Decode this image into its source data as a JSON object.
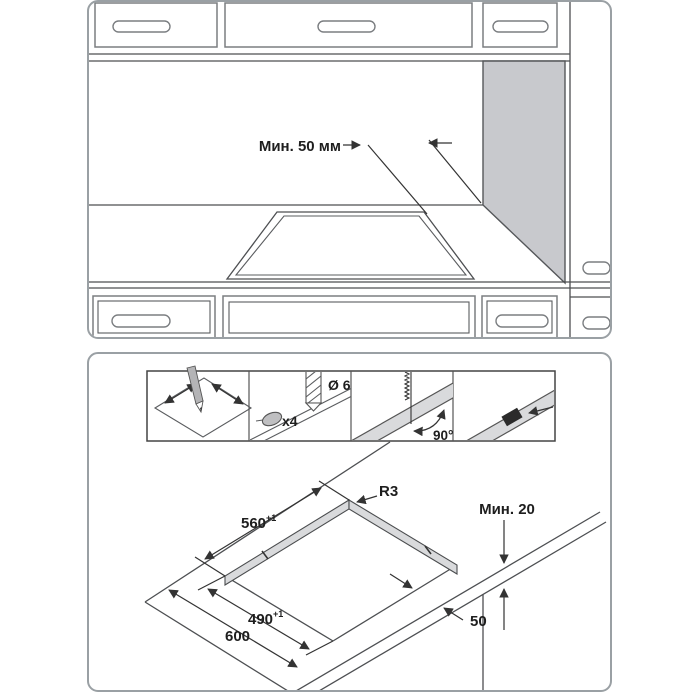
{
  "top_panel": {
    "min_clearance_label": "Мин. 50 мм"
  },
  "bottom_panel": {
    "steps": {
      "drill_diameter": "Ø 6",
      "screw_count": "x4",
      "cut_angle": "90°"
    },
    "dims": {
      "corner_radius": "R3",
      "cutout_width": "560",
      "cutout_width_tol": "+1",
      "cutout_depth": "490",
      "cutout_depth_tol": "+1",
      "worktop_depth": "600",
      "front_distance": "50",
      "min_edge": "Мин. 20"
    }
  },
  "colors": {
    "line": "#4d4f52",
    "panel_border": "#9aa0a4",
    "gray_fill": "#c8c9cd",
    "band_fill": "#d9dadc"
  }
}
